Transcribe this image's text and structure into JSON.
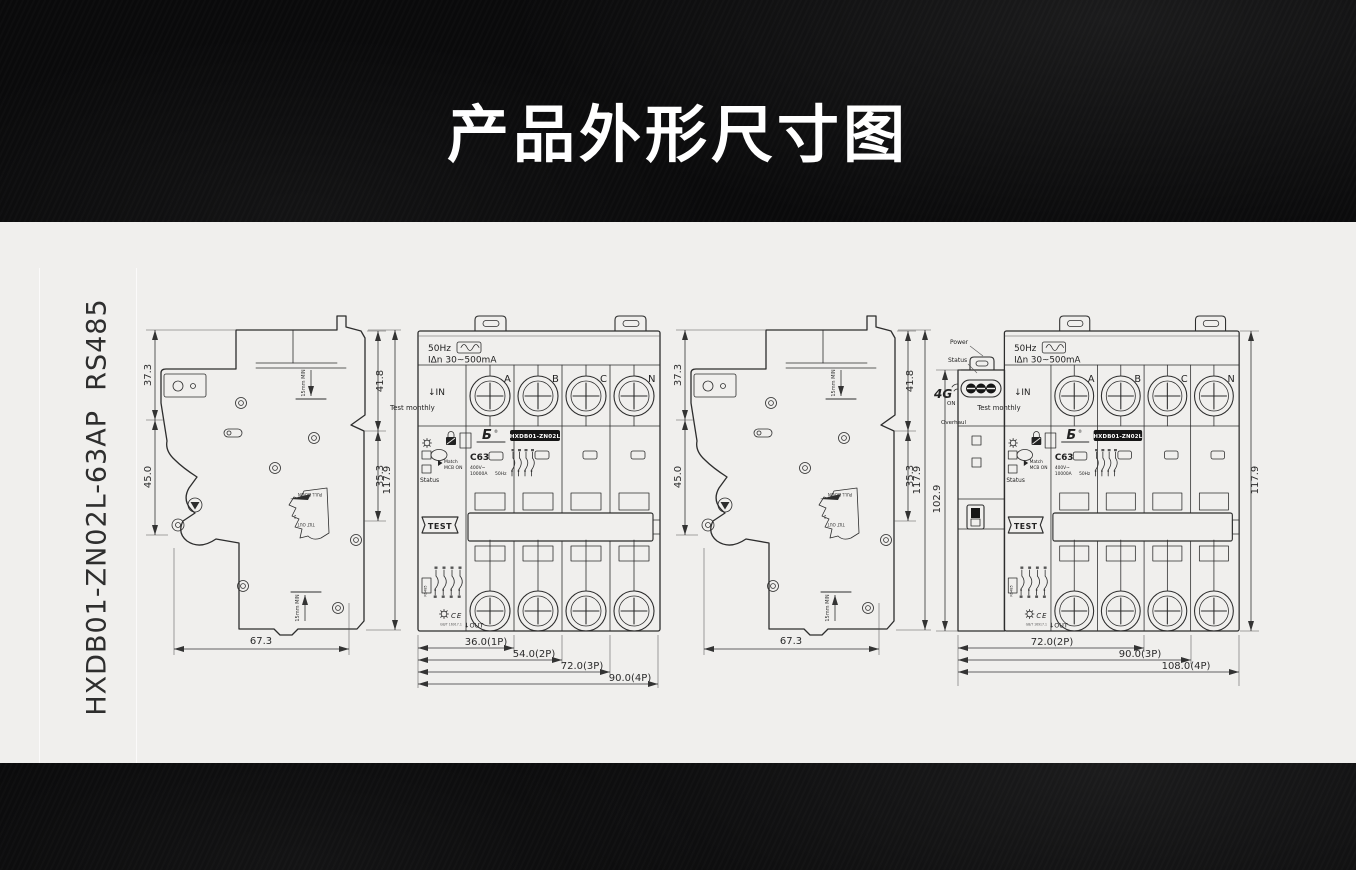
{
  "page": {
    "title": "产品外形尺寸图",
    "product_label": "HXDB01-ZN02L-63AP  RS485"
  },
  "colors": {
    "band_black": "#0a0a0b",
    "content_bg": "#f0efed",
    "line": "#2d2d2d",
    "model_label_bg": "#161616",
    "model_label_text": "#ffffff"
  },
  "icons": {
    "frequency_wave_icon": "∿",
    "down_arrow_icon": "↓",
    "gear_icon": "gear",
    "lock_icon": "lock",
    "pointing_hand_icon": "hand",
    "signal_arcs_icon": "4G-signal",
    "terminal_screw_icon": "crosshead-screw",
    "ce_icon": "CE"
  },
  "side_view": {
    "dim_front_height": "37.3",
    "dim_depth": "45.0",
    "dim_upper_right": "41.8",
    "dim_lower_right": "35.3",
    "dim_total_height": "117.9",
    "dim_total_depth": "67.3",
    "clearance_top": "15mm MIN",
    "clearance_bottom": "15mm MIN",
    "pull_down": "PULL DOWN",
    "tilt_out": "TILT OUT",
    "tilt_step": "2"
  },
  "breaker": {
    "frequency": "50Hz",
    "residual_current": "IΔn 30~500mA",
    "in_label": "↓IN",
    "out_label": "↓OUT",
    "poles": {
      "a": "A",
      "b": "B",
      "c": "C",
      "n": "N"
    },
    "test_monthly": "Test monthly",
    "status": "Status",
    "match": "Match",
    "mcb_on": "MCB ON",
    "rating": "C63",
    "model": "HXDB01-ZN02L",
    "voltage": "400V~",
    "breaking_capacity": "10000A",
    "rated_freq": "50Hz",
    "test_button": "TEST",
    "rs485": "RS485",
    "ce_mark": "CE",
    "standard": "GB/T 16917.1"
  },
  "front_view_1": {
    "dim_1p": "36.0(1P)",
    "dim_2p": "54.0(2P)",
    "dim_3p": "72.0(3P)",
    "dim_4p": "90.0(4P)"
  },
  "front_view_2": {
    "power": "Power",
    "status": "Status",
    "network": "4G",
    "on_label": "ON",
    "overhaul": "Overhaul",
    "dim_module_height": "102.9",
    "dim_total_height": "117.9",
    "dim_2p": "72.0(2P)",
    "dim_3p": "90.0(3P)",
    "dim_4p": "108.0(4P)"
  }
}
